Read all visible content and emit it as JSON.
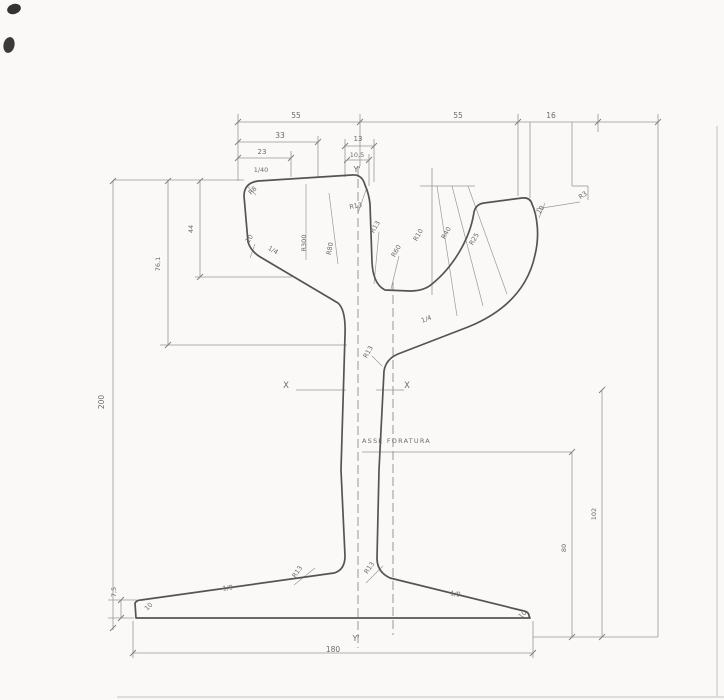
{
  "page": {
    "background": "#faf9f7"
  },
  "drawing": {
    "subject": "grooved tram rail cross-section, scanned dimensioned technical drawing",
    "hole_axis_label": "ASSE FORATURA",
    "axes": {
      "vertical_axis": "Y'",
      "horizontal_axis": "X"
    },
    "key_dimensions": {
      "overall_height": "200",
      "foot_width": "180",
      "head_height": "44",
      "head_to_web_depth": "76,1",
      "hole_axis_height": "80",
      "neutral_axis_height": "102",
      "foot_tip_height": "7,5",
      "head_top_slope": "1/40",
      "head_side_slope": "1/4",
      "foot_slope": "1/9"
    },
    "colors": {
      "profile_stroke": "#555451",
      "dimension_stroke": "#979693",
      "text": "#6d6c69",
      "scan_artifact": "#343434",
      "page_edge": "#cfcecb"
    },
    "labels": [
      {
        "id": "dim-top-55-left",
        "text": "55",
        "x": 296,
        "y": 118,
        "size": 7.5
      },
      {
        "id": "dim-top-55-right",
        "text": "55",
        "x": 458,
        "y": 118,
        "size": 7.5
      },
      {
        "id": "dim-top-16",
        "text": "16",
        "x": 551,
        "y": 118,
        "size": 7.5
      },
      {
        "id": "dim-33",
        "text": "33",
        "x": 280,
        "y": 138,
        "size": 7.5
      },
      {
        "id": "dim-13",
        "text": "13",
        "x": 358,
        "y": 141,
        "size": 7
      },
      {
        "id": "dim-23",
        "text": "23",
        "x": 262,
        "y": 154,
        "size": 7
      },
      {
        "id": "dim-10-5",
        "text": "10,5",
        "x": 357,
        "y": 157,
        "size": 6.5
      },
      {
        "id": "axis-y-top",
        "text": "Y'",
        "x": 357,
        "y": 172,
        "size": 8
      },
      {
        "id": "slope-1-40",
        "text": "1/40",
        "x": 261,
        "y": 172,
        "size": 6.5
      },
      {
        "id": "radius-r8-head",
        "text": "R8",
        "x": 254,
        "y": 192,
        "rot": -45,
        "size": 6.5
      },
      {
        "id": "dim-10-head-side",
        "text": "10",
        "x": 251,
        "y": 240,
        "rot": -55,
        "size": 6.5
      },
      {
        "id": "slope-1-4-head",
        "text": "1/4",
        "x": 272,
        "y": 252,
        "rot": 30,
        "size": 6.5
      },
      {
        "id": "radius-r300-crown",
        "text": "R300",
        "x": 306,
        "y": 243,
        "rot": -90,
        "size": 6.5
      },
      {
        "id": "radius-r80-crown",
        "text": "R80",
        "x": 332,
        "y": 249,
        "rot": -80,
        "size": 6.5
      },
      {
        "id": "radius-r13-head",
        "text": "R13",
        "x": 356,
        "y": 208,
        "rot": -10,
        "size": 6.5
      },
      {
        "id": "radius-r13-groove",
        "text": "R13",
        "x": 377,
        "y": 228,
        "rot": -60,
        "size": 6.5
      },
      {
        "id": "radius-r60-groove",
        "text": "R60",
        "x": 398,
        "y": 252,
        "rot": -60,
        "size": 6.5
      },
      {
        "id": "radius-r10-throat",
        "text": "R10",
        "x": 420,
        "y": 236,
        "rot": -60,
        "size": 6.5
      },
      {
        "id": "radius-r40-throat",
        "text": "R40",
        "x": 448,
        "y": 234,
        "rot": -60,
        "size": 6.5
      },
      {
        "id": "radius-r25-throat",
        "text": "R25",
        "x": 476,
        "y": 240,
        "rot": -60,
        "size": 6.5
      },
      {
        "id": "dim-10-guard-tip",
        "text": "10",
        "x": 542,
        "y": 211,
        "rot": -55,
        "size": 6.5
      },
      {
        "id": "radius-r3-guard",
        "text": "R3",
        "x": 584,
        "y": 197,
        "rot": -35,
        "size": 6.5
      },
      {
        "id": "slope-1-4-guard",
        "text": "1/4",
        "x": 427,
        "y": 321,
        "rot": -20,
        "size": 6.5
      },
      {
        "id": "radius-r13-web",
        "text": "R13",
        "x": 370,
        "y": 353,
        "rot": -60,
        "size": 6.5
      },
      {
        "id": "axis-x-left",
        "text": "X",
        "x": 286,
        "y": 388,
        "size": 8.5
      },
      {
        "id": "axis-x-right",
        "text": "X",
        "x": 407,
        "y": 388,
        "size": 8.5
      },
      {
        "id": "hole-axis-label",
        "text": "ASSE FORATURA",
        "x": 362,
        "y": 443,
        "size": 6.5,
        "anchor": "start",
        "spacing": 1.2
      },
      {
        "id": "dim-height-200",
        "text": "200",
        "x": 104,
        "y": 402,
        "rot": -90,
        "size": 7.5
      },
      {
        "id": "dim-76-1",
        "text": "76,1",
        "x": 160,
        "y": 264,
        "rot": -90,
        "size": 6.5
      },
      {
        "id": "dim-44",
        "text": "44",
        "x": 193,
        "y": 229,
        "rot": -90,
        "size": 6.5
      },
      {
        "id": "dim-7-5",
        "text": "7,5",
        "x": 116,
        "y": 592,
        "rot": -90,
        "size": 6.5
      },
      {
        "id": "dim-10-foot-left",
        "text": "10",
        "x": 150,
        "y": 608,
        "rot": -45,
        "size": 6.5
      },
      {
        "id": "slope-1-9-left",
        "text": "1/9",
        "x": 228,
        "y": 590,
        "rot": -8,
        "size": 6.5
      },
      {
        "id": "radius-r13-foot-left",
        "text": "R13",
        "x": 299,
        "y": 573,
        "rot": -55,
        "size": 6.5
      },
      {
        "id": "radius-r13-foot-right",
        "text": "R13",
        "x": 371,
        "y": 569,
        "rot": -55,
        "size": 6.5
      },
      {
        "id": "slope-1-9-right",
        "text": "1/9",
        "x": 455,
        "y": 596,
        "rot": 9,
        "size": 6.5
      },
      {
        "id": "dim-10-foot-right",
        "text": "10",
        "x": 524,
        "y": 616,
        "rot": -45,
        "size": 6.5
      },
      {
        "id": "dim-foot-180",
        "text": "180",
        "x": 333,
        "y": 652,
        "size": 7.5
      },
      {
        "id": "axis-y-bottom",
        "text": "Y'",
        "x": 356,
        "y": 641,
        "size": 8
      },
      {
        "id": "dim-80-hole-axis",
        "text": "80",
        "x": 566,
        "y": 548,
        "rot": -90,
        "size": 6.5
      },
      {
        "id": "dim-102-neutral-axis",
        "text": "102",
        "x": 596,
        "y": 514,
        "rot": -90,
        "size": 6.5
      }
    ]
  }
}
